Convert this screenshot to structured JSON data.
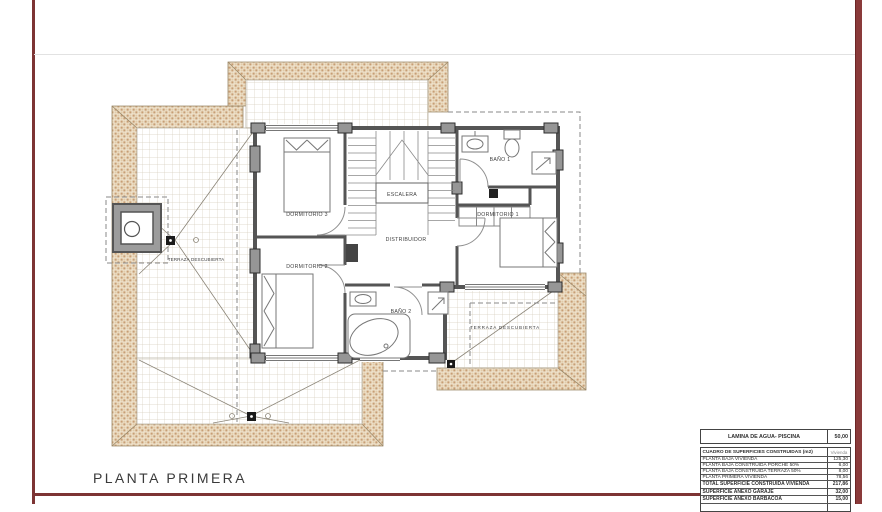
{
  "sheet": {
    "title": "PLANTA PRIMERA",
    "accent_color": "#7d3434"
  },
  "plan": {
    "rooms": [
      {
        "label": "DORMITORIO 3"
      },
      {
        "label": "DORMITORIO 2"
      },
      {
        "label": "DORMITORIO 1"
      },
      {
        "label": "BAÑO 1"
      },
      {
        "label": "BAÑO 2"
      },
      {
        "label": "ESCALERA"
      },
      {
        "label": "DISTRIBUIDOR"
      },
      {
        "label": "TERRAZA DESCUBIERTA"
      },
      {
        "label": "TERRAZA DESCUBIERTA"
      }
    ],
    "colors": {
      "roof_tile": "#c79e74",
      "wall": "#555555",
      "grid_line": "#d8d0c0"
    }
  },
  "summary_table": {
    "water_row": {
      "label": "LAMINA DE AGUA- PISCINA",
      "value": "50,00"
    },
    "header_row": {
      "label": "CUADRO DE SUPERFICIES CONSTRUIDAS (m2)",
      "value": "Vivienda"
    },
    "rows": [
      {
        "label": "PLANTA BAJA VIVIENDA",
        "value": "125,30"
      },
      {
        "label": "PLANTA BAJA CONSTRUIDA PORCHE 50%",
        "value": "6,00"
      },
      {
        "label": "PLANTA BAJA CONSTRUIDA TERRAZA 50%",
        "value": "8,00"
      },
      {
        "label": "PLANTA PRIMERA VIVIENDA",
        "value": "78,56"
      },
      {
        "label": "TOTAL SUPERFICIE CONSTRUIDA VIVIENDA",
        "value": "217,86"
      },
      {
        "label": "SUPERFICIE ANEXO GARAJE",
        "value": "32,00"
      },
      {
        "label": "SUPERFICIE ANEXO BARBACOA",
        "value": "15,00"
      }
    ]
  }
}
